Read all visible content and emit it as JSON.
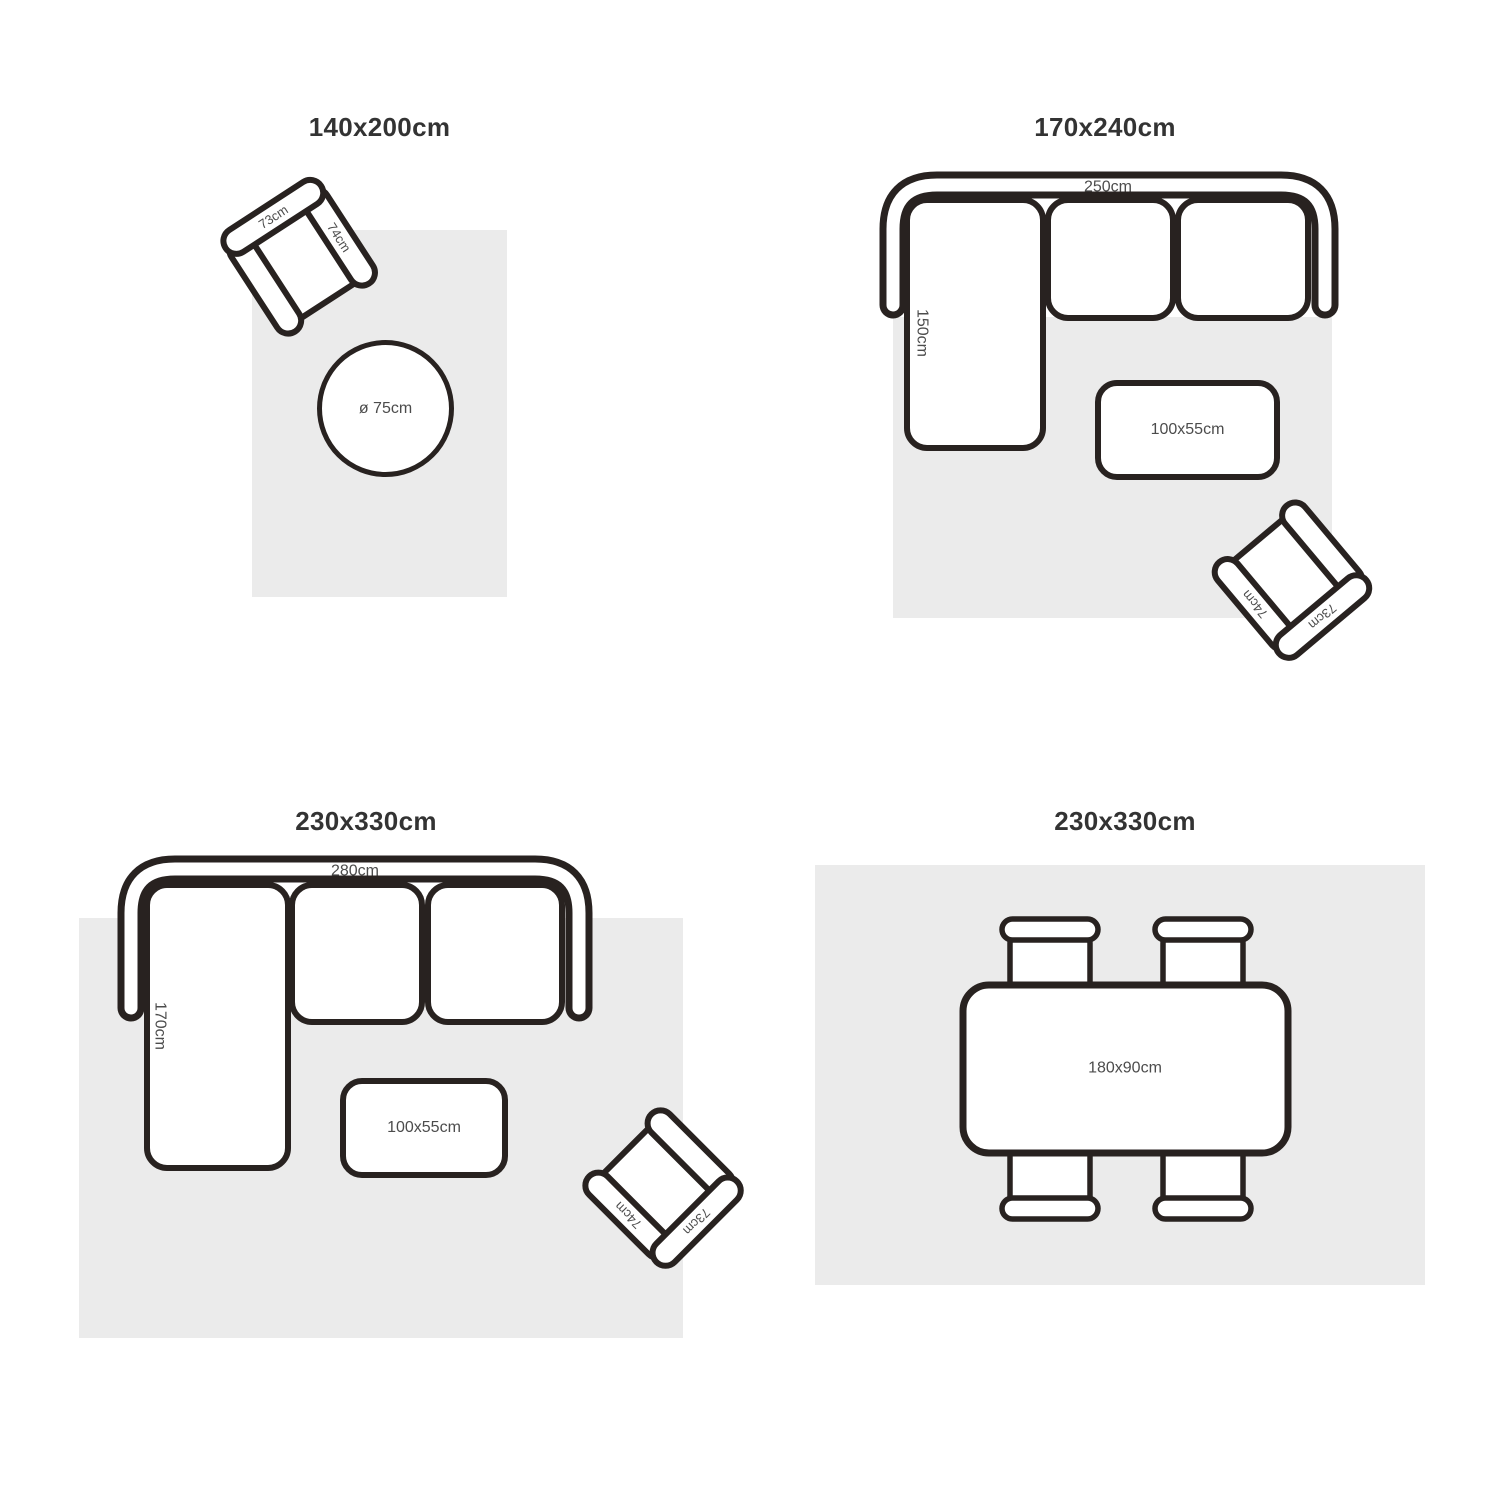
{
  "colors": {
    "background": "#ffffff",
    "rug": "#ebebeb",
    "outline": "#282220",
    "title_text": "#333333",
    "label_text": "#4c4c4c"
  },
  "layouts": {
    "small": {
      "title": "140x200cm",
      "armchair": {
        "back": "73cm",
        "side": "74cm"
      },
      "round_table": "ø 75cm"
    },
    "medium": {
      "title": "170x240cm",
      "sofa": {
        "width": "250cm",
        "depth": "150cm"
      },
      "coffee_table": "100x55cm",
      "armchair": {
        "back": "73cm",
        "side": "74cm"
      }
    },
    "large": {
      "title": "230x330cm",
      "sofa": {
        "width": "280cm",
        "depth": "170cm"
      },
      "coffee_table": "100x55cm",
      "armchair": {
        "back": "73cm",
        "side": "74cm"
      }
    },
    "dining": {
      "title": "230x330cm",
      "table": "180x90cm"
    }
  }
}
